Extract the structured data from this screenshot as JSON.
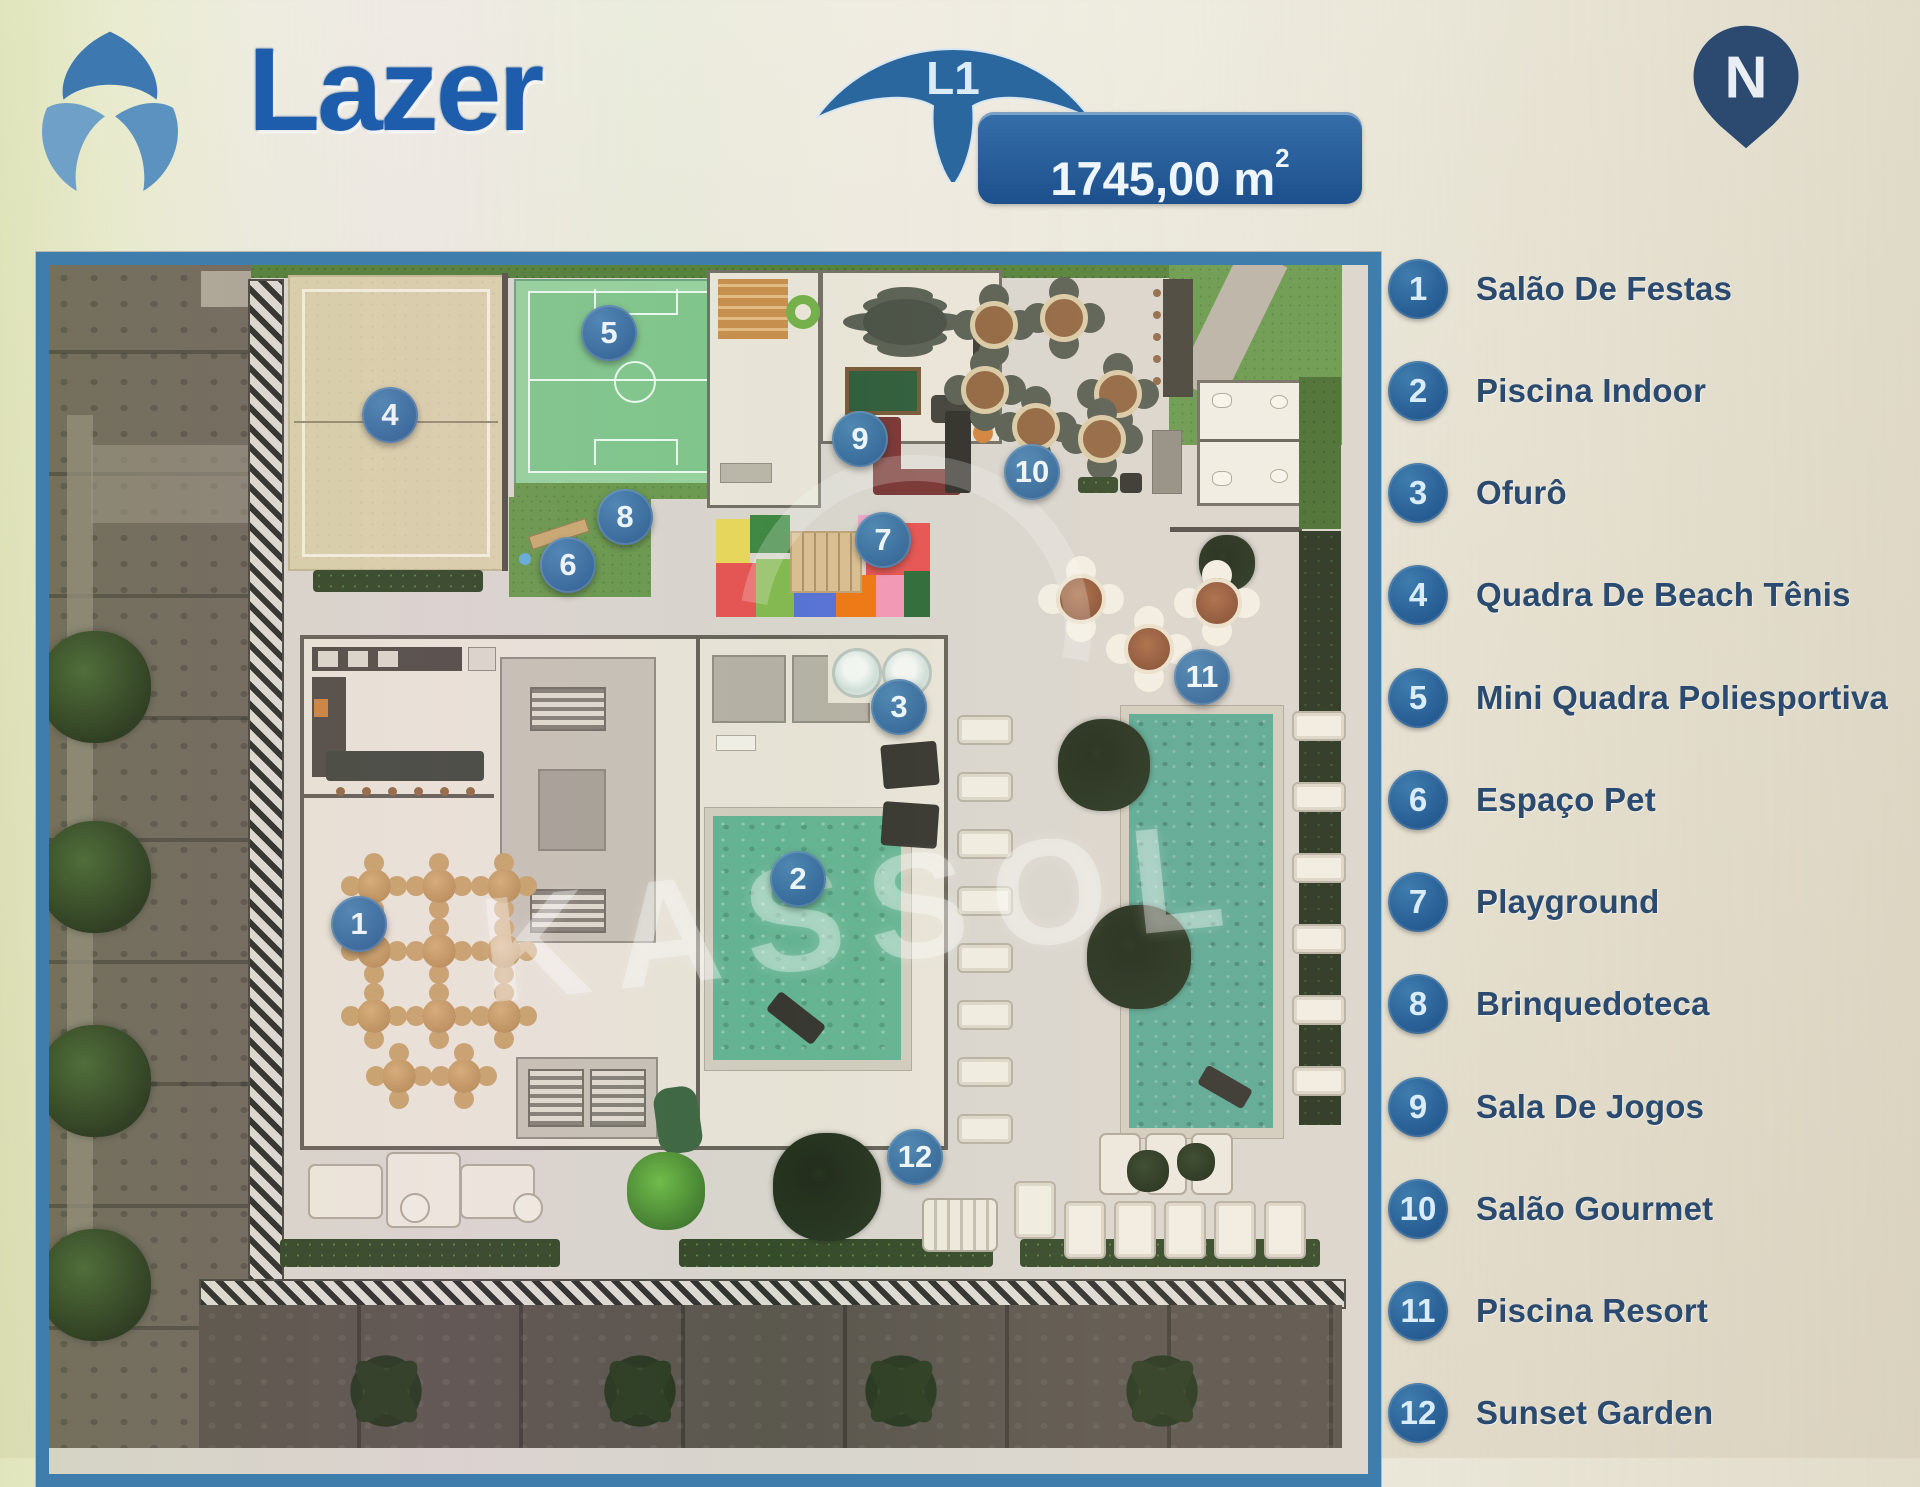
{
  "header": {
    "title": "Lazer",
    "level_badge": "L1",
    "area_value": "1745,00 m",
    "area_sup": "2",
    "north_label": "N"
  },
  "watermark": {
    "text": "KASSOL"
  },
  "plan": {
    "markers": [
      "1",
      "2",
      "3",
      "4",
      "5",
      "6",
      "7",
      "8",
      "9",
      "10",
      "11",
      "12"
    ]
  },
  "legend": {
    "items": [
      {
        "number": "1",
        "label": "Salão De Festas"
      },
      {
        "number": "2",
        "label": "Piscina Indoor"
      },
      {
        "number": "3",
        "label": "Ofurô"
      },
      {
        "number": "4",
        "label": "Quadra De Beach Tênis"
      },
      {
        "number": "5",
        "label": "Mini Quadra Poliesportiva"
      },
      {
        "number": "6",
        "label": "Espaço Pet"
      },
      {
        "number": "7",
        "label": "Playground"
      },
      {
        "number": "8",
        "label": "Brinquedoteca"
      },
      {
        "number": "9",
        "label": "Sala De Jogos"
      },
      {
        "number": "10",
        "label": "Salão Gourmet"
      },
      {
        "number": "11",
        "label": "Piscina Resort"
      },
      {
        "number": "12",
        "label": "Sunset Garden"
      }
    ]
  },
  "colors": {
    "brand_blue": "#1e5dab",
    "badge_blue": "#2a679f",
    "pill_blue": "#1d508d",
    "frame_blue": "#3e7dac",
    "marker_blue": "#2e6ea8",
    "legend_text": "#2b4a70",
    "indoor_pool_green": "#58ad8b",
    "resort_pool_teal": "#4fa28d",
    "court_green": "#76c283",
    "sand_court": "#d7cda6"
  }
}
